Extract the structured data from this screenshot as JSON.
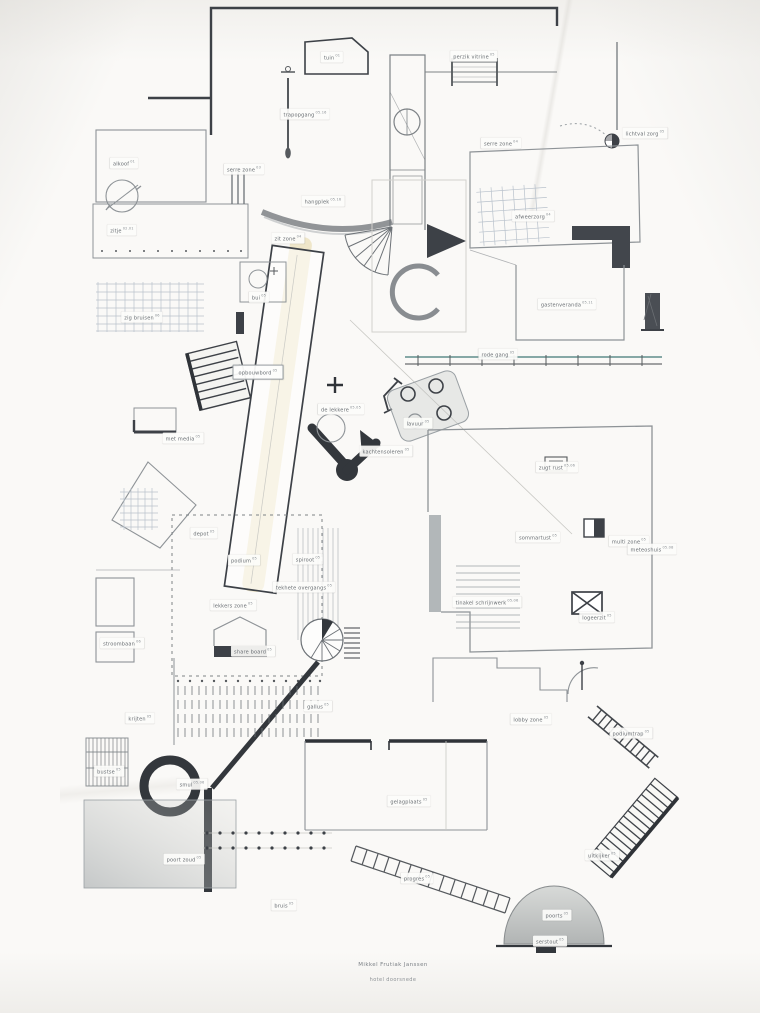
{
  "artwork": {
    "type": "architectural plan collage drawing",
    "caption_line1": "Mikkel Frutiak Janssen",
    "caption_line2": "hotel doorsnede",
    "colors": {
      "paper": "#faf9f7",
      "pencil": "#8e9397",
      "pencil_light": "#b9c2cc",
      "ink": "#3d4147",
      "highlight": "#e3cf91",
      "teal_line": "#5f8e8c",
      "wash": "#9aa0a2"
    },
    "labels": [
      {
        "id": "tuin",
        "text": "tuin 01",
        "x": 332,
        "y": 57
      },
      {
        "id": "trapopgang",
        "text": "trapopgang 05.16",
        "x": 305,
        "y": 114
      },
      {
        "id": "alkoof",
        "text": "alkoof 01",
        "x": 124,
        "y": 163
      },
      {
        "id": "zitje",
        "text": "zitje 02.01",
        "x": 122,
        "y": 230
      },
      {
        "id": "serre-zone-links",
        "text": "serre zone 03",
        "x": 244,
        "y": 169
      },
      {
        "id": "zit-zone",
        "text": "zit zone 04",
        "x": 288,
        "y": 238
      },
      {
        "id": "hangplek",
        "text": "hangplek 05.16",
        "x": 323,
        "y": 201
      },
      {
        "id": "perzik-vitrine",
        "text": "perzik vitrine 05",
        "x": 474,
        "y": 56
      },
      {
        "id": "serre-zone-rechts",
        "text": "serre zone 04",
        "x": 501,
        "y": 143
      },
      {
        "id": "afweerzorg",
        "text": "afweerzorg 04",
        "x": 533,
        "y": 216
      },
      {
        "id": "lichtval-zorg",
        "text": "lichtval zorg 05",
        "x": 645,
        "y": 133
      },
      {
        "id": "gastenveranda",
        "text": "gastenveranda 05.11",
        "x": 567,
        "y": 304
      },
      {
        "id": "rode-gang",
        "text": "rode gang 05",
        "x": 498,
        "y": 354
      },
      {
        "id": "zig-bruisen",
        "text": "zig bruisen 06",
        "x": 142,
        "y": 317
      },
      {
        "id": "bui",
        "text": "bui 05",
        "x": 259,
        "y": 297
      },
      {
        "id": "opbouwbord",
        "text": "opbouwbord 05",
        "x": 258,
        "y": 372,
        "boxed": true
      },
      {
        "id": "met-media",
        "text": "met media 05",
        "x": 183,
        "y": 438
      },
      {
        "id": "de-lekkere",
        "text": "de lekkere 05.05",
        "x": 341,
        "y": 409
      },
      {
        "id": "lavuur",
        "text": "lavuur 05",
        "x": 418,
        "y": 423
      },
      {
        "id": "kachtensoleren",
        "text": "kachtensoleren 05",
        "x": 386,
        "y": 451
      },
      {
        "id": "zugt-rust",
        "text": "zugt rust 05.06",
        "x": 557,
        "y": 467
      },
      {
        "id": "sommartust",
        "text": "sommartust 05",
        "x": 538,
        "y": 537
      },
      {
        "id": "multi-zone",
        "text": "multi zone 05",
        "x": 629,
        "y": 541
      },
      {
        "id": "meteoshuis",
        "text": "meteoshuis 05.08",
        "x": 652,
        "y": 549
      },
      {
        "id": "tinakel-schrijnwerk",
        "text": "tinakel schrijnwerk 05.06",
        "x": 487,
        "y": 602
      },
      {
        "id": "logeerzit",
        "text": "logeerzit 05",
        "x": 597,
        "y": 617
      },
      {
        "id": "depot",
        "text": "depot 05",
        "x": 204,
        "y": 533
      },
      {
        "id": "podium",
        "text": "podium 05",
        "x": 244,
        "y": 560
      },
      {
        "id": "spiroot",
        "text": "spiroot 05",
        "x": 308,
        "y": 559
      },
      {
        "id": "tekhete-overgangs",
        "text": "tekhete overgangs 05",
        "x": 304,
        "y": 587
      },
      {
        "id": "lekkers-zone",
        "text": "lekkers zone 05",
        "x": 233,
        "y": 605
      },
      {
        "id": "share-board",
        "text": "share board 05",
        "x": 253,
        "y": 651
      },
      {
        "id": "stroombaan",
        "text": "stroombaan 06",
        "x": 122,
        "y": 643
      },
      {
        "id": "krijten",
        "text": "krijten 05",
        "x": 140,
        "y": 718
      },
      {
        "id": "gallus",
        "text": "gallus 05",
        "x": 318,
        "y": 706
      },
      {
        "id": "lobby-zone",
        "text": "lobby zone 05",
        "x": 531,
        "y": 719
      },
      {
        "id": "podiumtrap",
        "text": "podiumtrap 05",
        "x": 631,
        "y": 733
      },
      {
        "id": "bustse",
        "text": "bustse 05",
        "x": 109,
        "y": 771
      },
      {
        "id": "smul",
        "text": "smul 05.06",
        "x": 192,
        "y": 784
      },
      {
        "id": "gelagplaats",
        "text": "gelagplaats 05",
        "x": 409,
        "y": 801
      },
      {
        "id": "poort-zoud",
        "text": "poort zoud 05",
        "x": 184,
        "y": 859
      },
      {
        "id": "progres",
        "text": "progres 05",
        "x": 417,
        "y": 878
      },
      {
        "id": "bruis",
        "text": "bruis 05",
        "x": 284,
        "y": 905
      },
      {
        "id": "uitkijker",
        "text": "uitkijker 05",
        "x": 602,
        "y": 855
      },
      {
        "id": "poorts",
        "text": "poorts 05",
        "x": 557,
        "y": 915
      },
      {
        "id": "serstout",
        "text": "serstout 05",
        "x": 550,
        "y": 941
      }
    ]
  }
}
